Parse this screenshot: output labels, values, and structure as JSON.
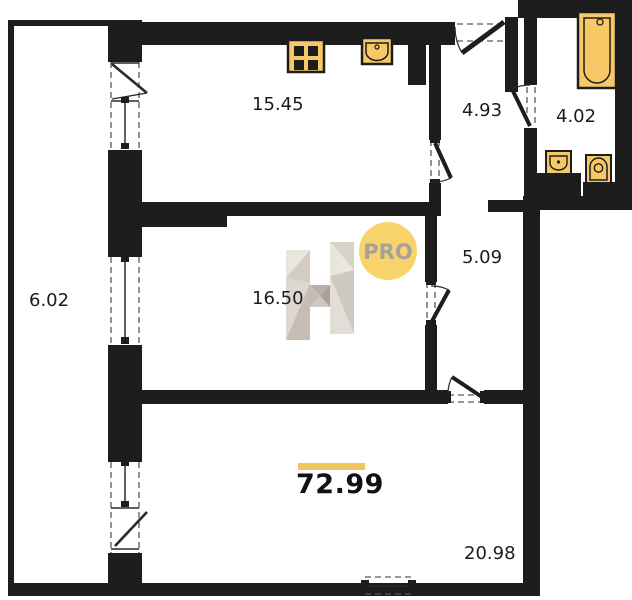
{
  "watermark": {
    "letter": "H",
    "badge": "PRO"
  },
  "areas": {
    "kitchen": "15.45",
    "hallway": "4.93",
    "bathroom": "4.02",
    "balcony": "6.02",
    "room": "16.50",
    "corridor": "5.09",
    "living_room": "20.98",
    "total": "72.99"
  },
  "colors": {
    "wall": "#1d1d1d",
    "fixture_fill": "#F6C966",
    "accent_bar": "#F0C75F",
    "badge_fill": "#F8D26A",
    "badge_text": "#A8A198",
    "watermark_grays": [
      "#E9E5DF",
      "#D8D2C9",
      "#CBC4BA",
      "#B9B1A6"
    ]
  }
}
